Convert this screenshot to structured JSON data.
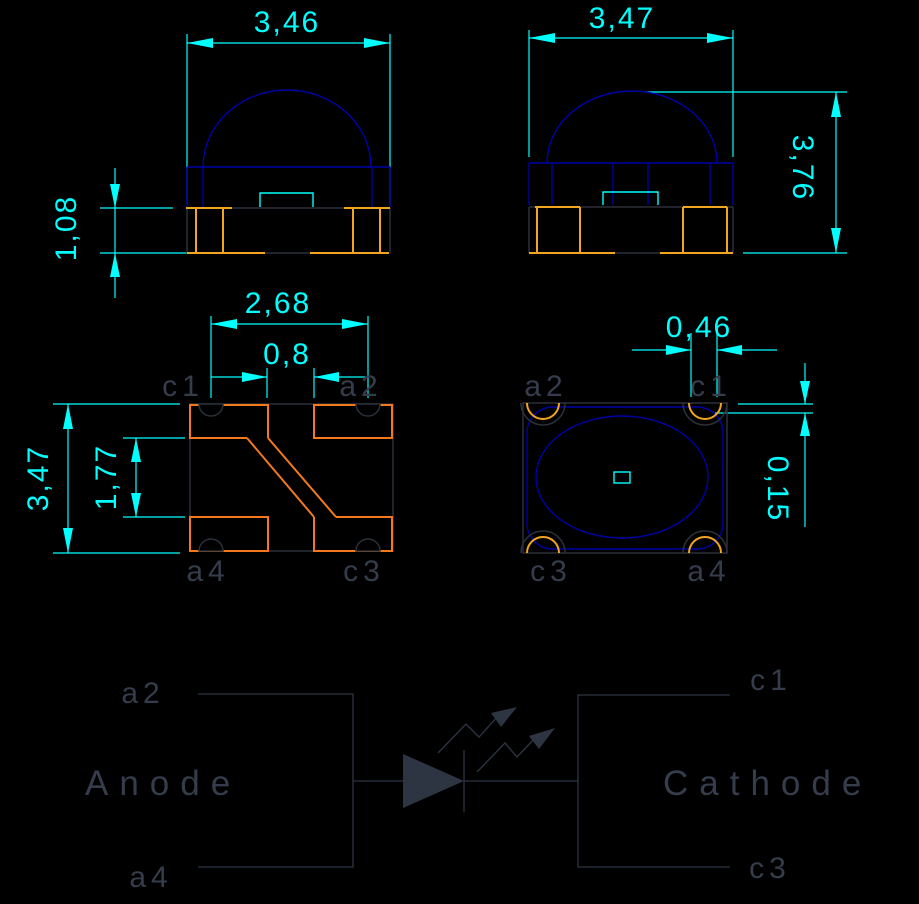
{
  "colors": {
    "background": "#000000",
    "dimension": "#00ffff",
    "body_blue": "#0000a8",
    "pad_orange": "#f4791d",
    "pad_gold": "#f2a51f",
    "outline_dark": "#2a3039",
    "schematic": "#2e3542",
    "label_text": "#353d4c"
  },
  "views": {
    "front": {
      "dim_width": "3,46",
      "dim_pad_height": "1,08"
    },
    "side": {
      "dim_width": "3,47",
      "dim_total_height": "3,76"
    },
    "footprint": {
      "dim_pad_span": "2,68",
      "dim_center_gap": "0,8",
      "dim_height": "3,47",
      "dim_pad_gap": "1,77",
      "pins": {
        "top_left": "c1",
        "top_right": "a2",
        "bottom_left": "a4",
        "bottom_right": "c3"
      }
    },
    "top": {
      "dim_notch_width": "0,46",
      "dim_edge_offset": "0,15",
      "pins": {
        "top_left": "a2",
        "top_right": "c1",
        "bottom_left": "c3",
        "bottom_right": "a4"
      }
    },
    "schematic": {
      "anode": {
        "label": "Anode",
        "pin_top": "a2",
        "pin_bottom": "a4"
      },
      "cathode": {
        "label": "Cathode",
        "pin_top": "c1",
        "pin_bottom": "c3"
      }
    }
  }
}
